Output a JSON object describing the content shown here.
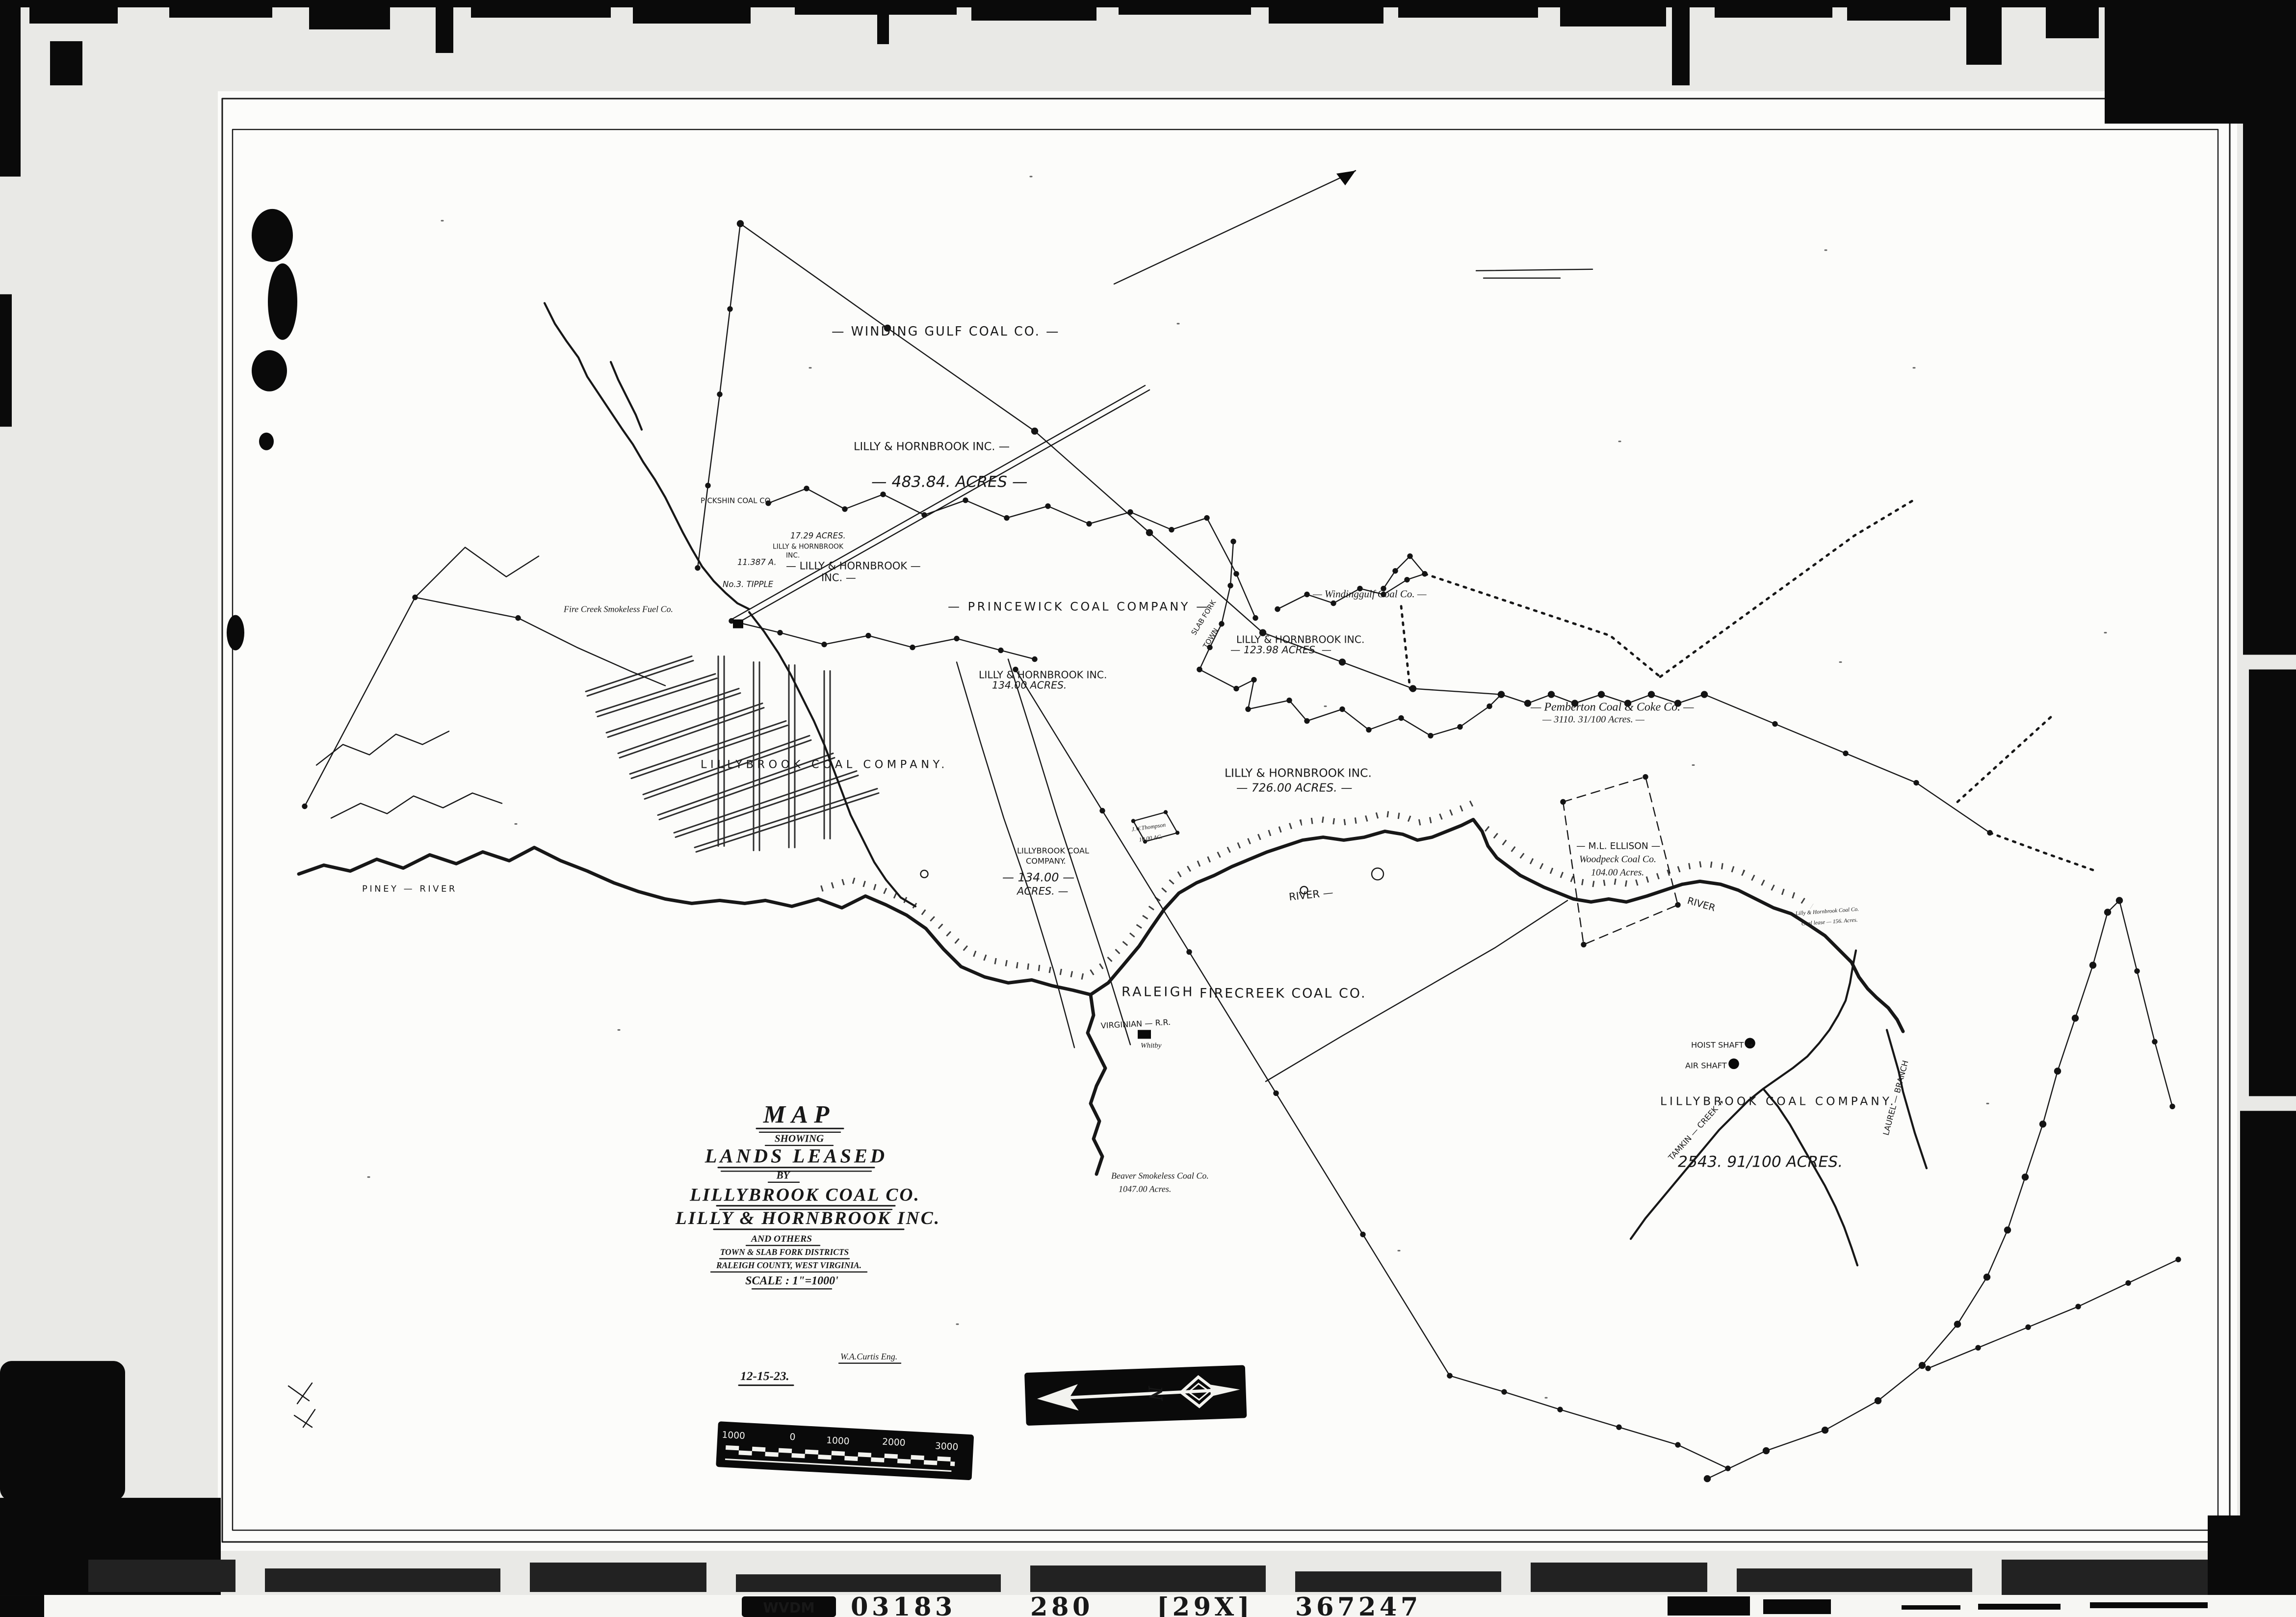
{
  "film": {
    "archive_label": "WVDM",
    "frame_numbers": [
      "03183",
      "280",
      "[29X]",
      "367247"
    ]
  },
  "title_block": {
    "title": "MAP",
    "subtitle": "SHOWING",
    "line3": "LANDS LEASED",
    "line4": "BY",
    "company1": "LILLYBROOK COAL CO.",
    "company2": "LILLY & HORNBROOK INC.",
    "others": "AND OTHERS",
    "districts": "TOWN & SLAB FORK DISTRICTS",
    "county": "RALEIGH COUNTY, WEST VIRGINIA.",
    "scale": "SCALE : 1\"=1000'",
    "engineer": "W.A.Curtis Eng.",
    "date": "12-15-23."
  },
  "compass": {
    "letter": "N"
  },
  "scale_bar": {
    "ticks": [
      "1000",
      "0",
      "1000",
      "2000",
      "3000"
    ]
  },
  "labels": [
    {
      "text": "— WINDING GULF COAL CO. —"
    },
    {
      "text": "LILLY & HORNBROOK INC. —"
    },
    {
      "text": "— 483.84. ACRES —"
    },
    {
      "text": "PICKSHIN COAL CO."
    },
    {
      "text": "17.29 ACRES."
    },
    {
      "text": "LILLY & HORNBROOK"
    },
    {
      "text": "INC."
    },
    {
      "text": "11.387 A."
    },
    {
      "text": "No.3. TIPPLE"
    },
    {
      "text": "— LILLY & HORNBROOK —"
    },
    {
      "text": "INC. —"
    },
    {
      "text": "Fire Creek Smokeless Fuel Co."
    },
    {
      "text": "— PRINCEWICK COAL COMPANY —"
    },
    {
      "text": "— Windinggulf Coal Co. —"
    },
    {
      "text": "SLAB FORK"
    },
    {
      "text": "TOWN"
    },
    {
      "text": "LILLY & HORNBROOK INC."
    },
    {
      "text": "— 123.98 ACRES. —"
    },
    {
      "text": "LILLY & HORNBROOK INC."
    },
    {
      "text": "134.00 ACRES."
    },
    {
      "text": "— Pemberton Coal & Coke Co. —"
    },
    {
      "text": "— 3110. 31/100 Acres. —"
    },
    {
      "text": "LILLY & HORNBROOK INC."
    },
    {
      "text": "— 726.00 ACRES. —"
    },
    {
      "text": "LILLYBROOK COAL COMPANY."
    },
    {
      "text": "LILLYBROOK COAL"
    },
    {
      "text": "COMPANY."
    },
    {
      "text": "— 134.00 —"
    },
    {
      "text": "ACRES. —"
    },
    {
      "text": "J.W.Thompson"
    },
    {
      "text": "10.00 AC."
    },
    {
      "text": "— M.L. ELLISON —"
    },
    {
      "text": "Woodpeck Coal Co."
    },
    {
      "text": "104.00 Acres."
    },
    {
      "text": "PINEY — RIVER"
    },
    {
      "text": "RIVER —"
    },
    {
      "text": "RIVER"
    },
    {
      "text": "RALEIGH"
    },
    {
      "text": "FIRECREEK COAL CO."
    },
    {
      "text": "VIRGINIAN — R.R."
    },
    {
      "text": "Whitby"
    },
    {
      "text": "Beaver Smokeless Coal Co."
    },
    {
      "text": "1047.00 Acres."
    },
    {
      "text": "HOIST SHAFT →"
    },
    {
      "text": "AIR SHAFT"
    },
    {
      "text": "LILLYBROOK  COAL  COMPANY."
    },
    {
      "text": "TAMKIN — CREEK →"
    },
    {
      "text": "2543. 91/100  ACRES."
    },
    {
      "text": "LAUREL — BRANCH"
    },
    {
      "text": "Lilly & Hornbrook Coal Co."
    },
    {
      "text": "Coal lease — 156. Acres."
    }
  ]
}
